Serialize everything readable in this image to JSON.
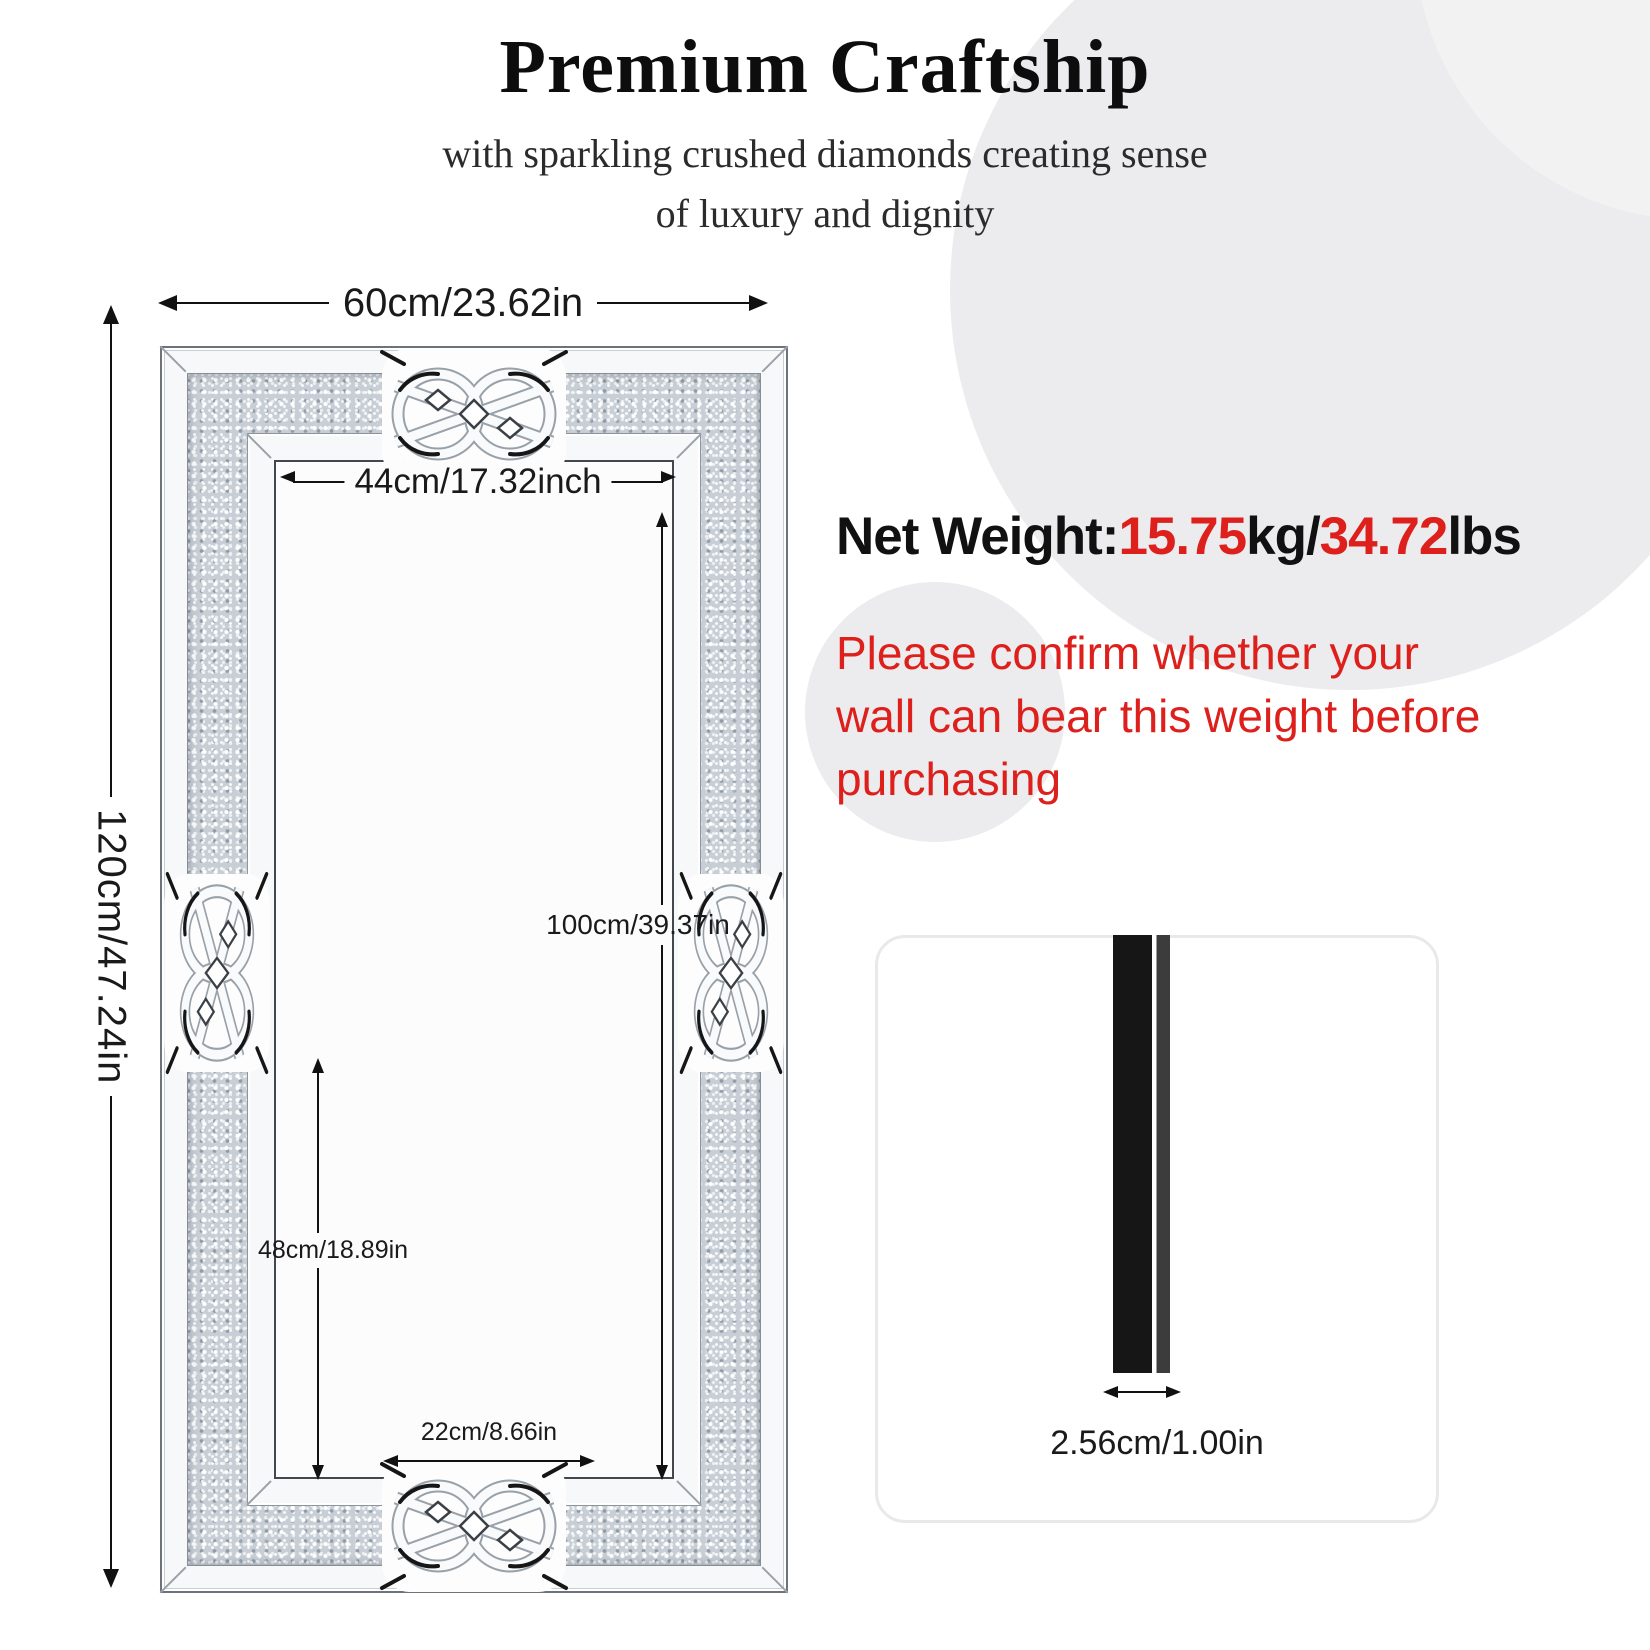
{
  "header": {
    "title": "Premium Craftship",
    "subtitle_line1": "with sparkling crushed diamonds creating sense",
    "subtitle_line2": "of luxury and dignity"
  },
  "mirror_dimensions": {
    "overall_width": "60cm/23.62in",
    "overall_height": "120cm/47.24in",
    "inner_width": "44cm/17.32inch",
    "inner_height": "100cm/39.37in",
    "lower_inner_height": "48cm/18.89in",
    "bottom_inner_width": "22cm/8.66in"
  },
  "weight": {
    "label": "Net Weight:",
    "kg_value": "15.75",
    "kg_unit": "kg/",
    "lbs_value": "34.72",
    "lbs_unit": "lbs"
  },
  "warning": {
    "line1": "Please confirm whether your",
    "line2": "wall can bear this weight before",
    "line3": "purchasing"
  },
  "thickness": {
    "label": "2.56cm/1.00in"
  },
  "colors": {
    "accent_red": "#dd201c",
    "background_circle_gray": "#ececee",
    "diamond_band_base": "#c8ced5",
    "profile_bar_black": "#161616"
  }
}
